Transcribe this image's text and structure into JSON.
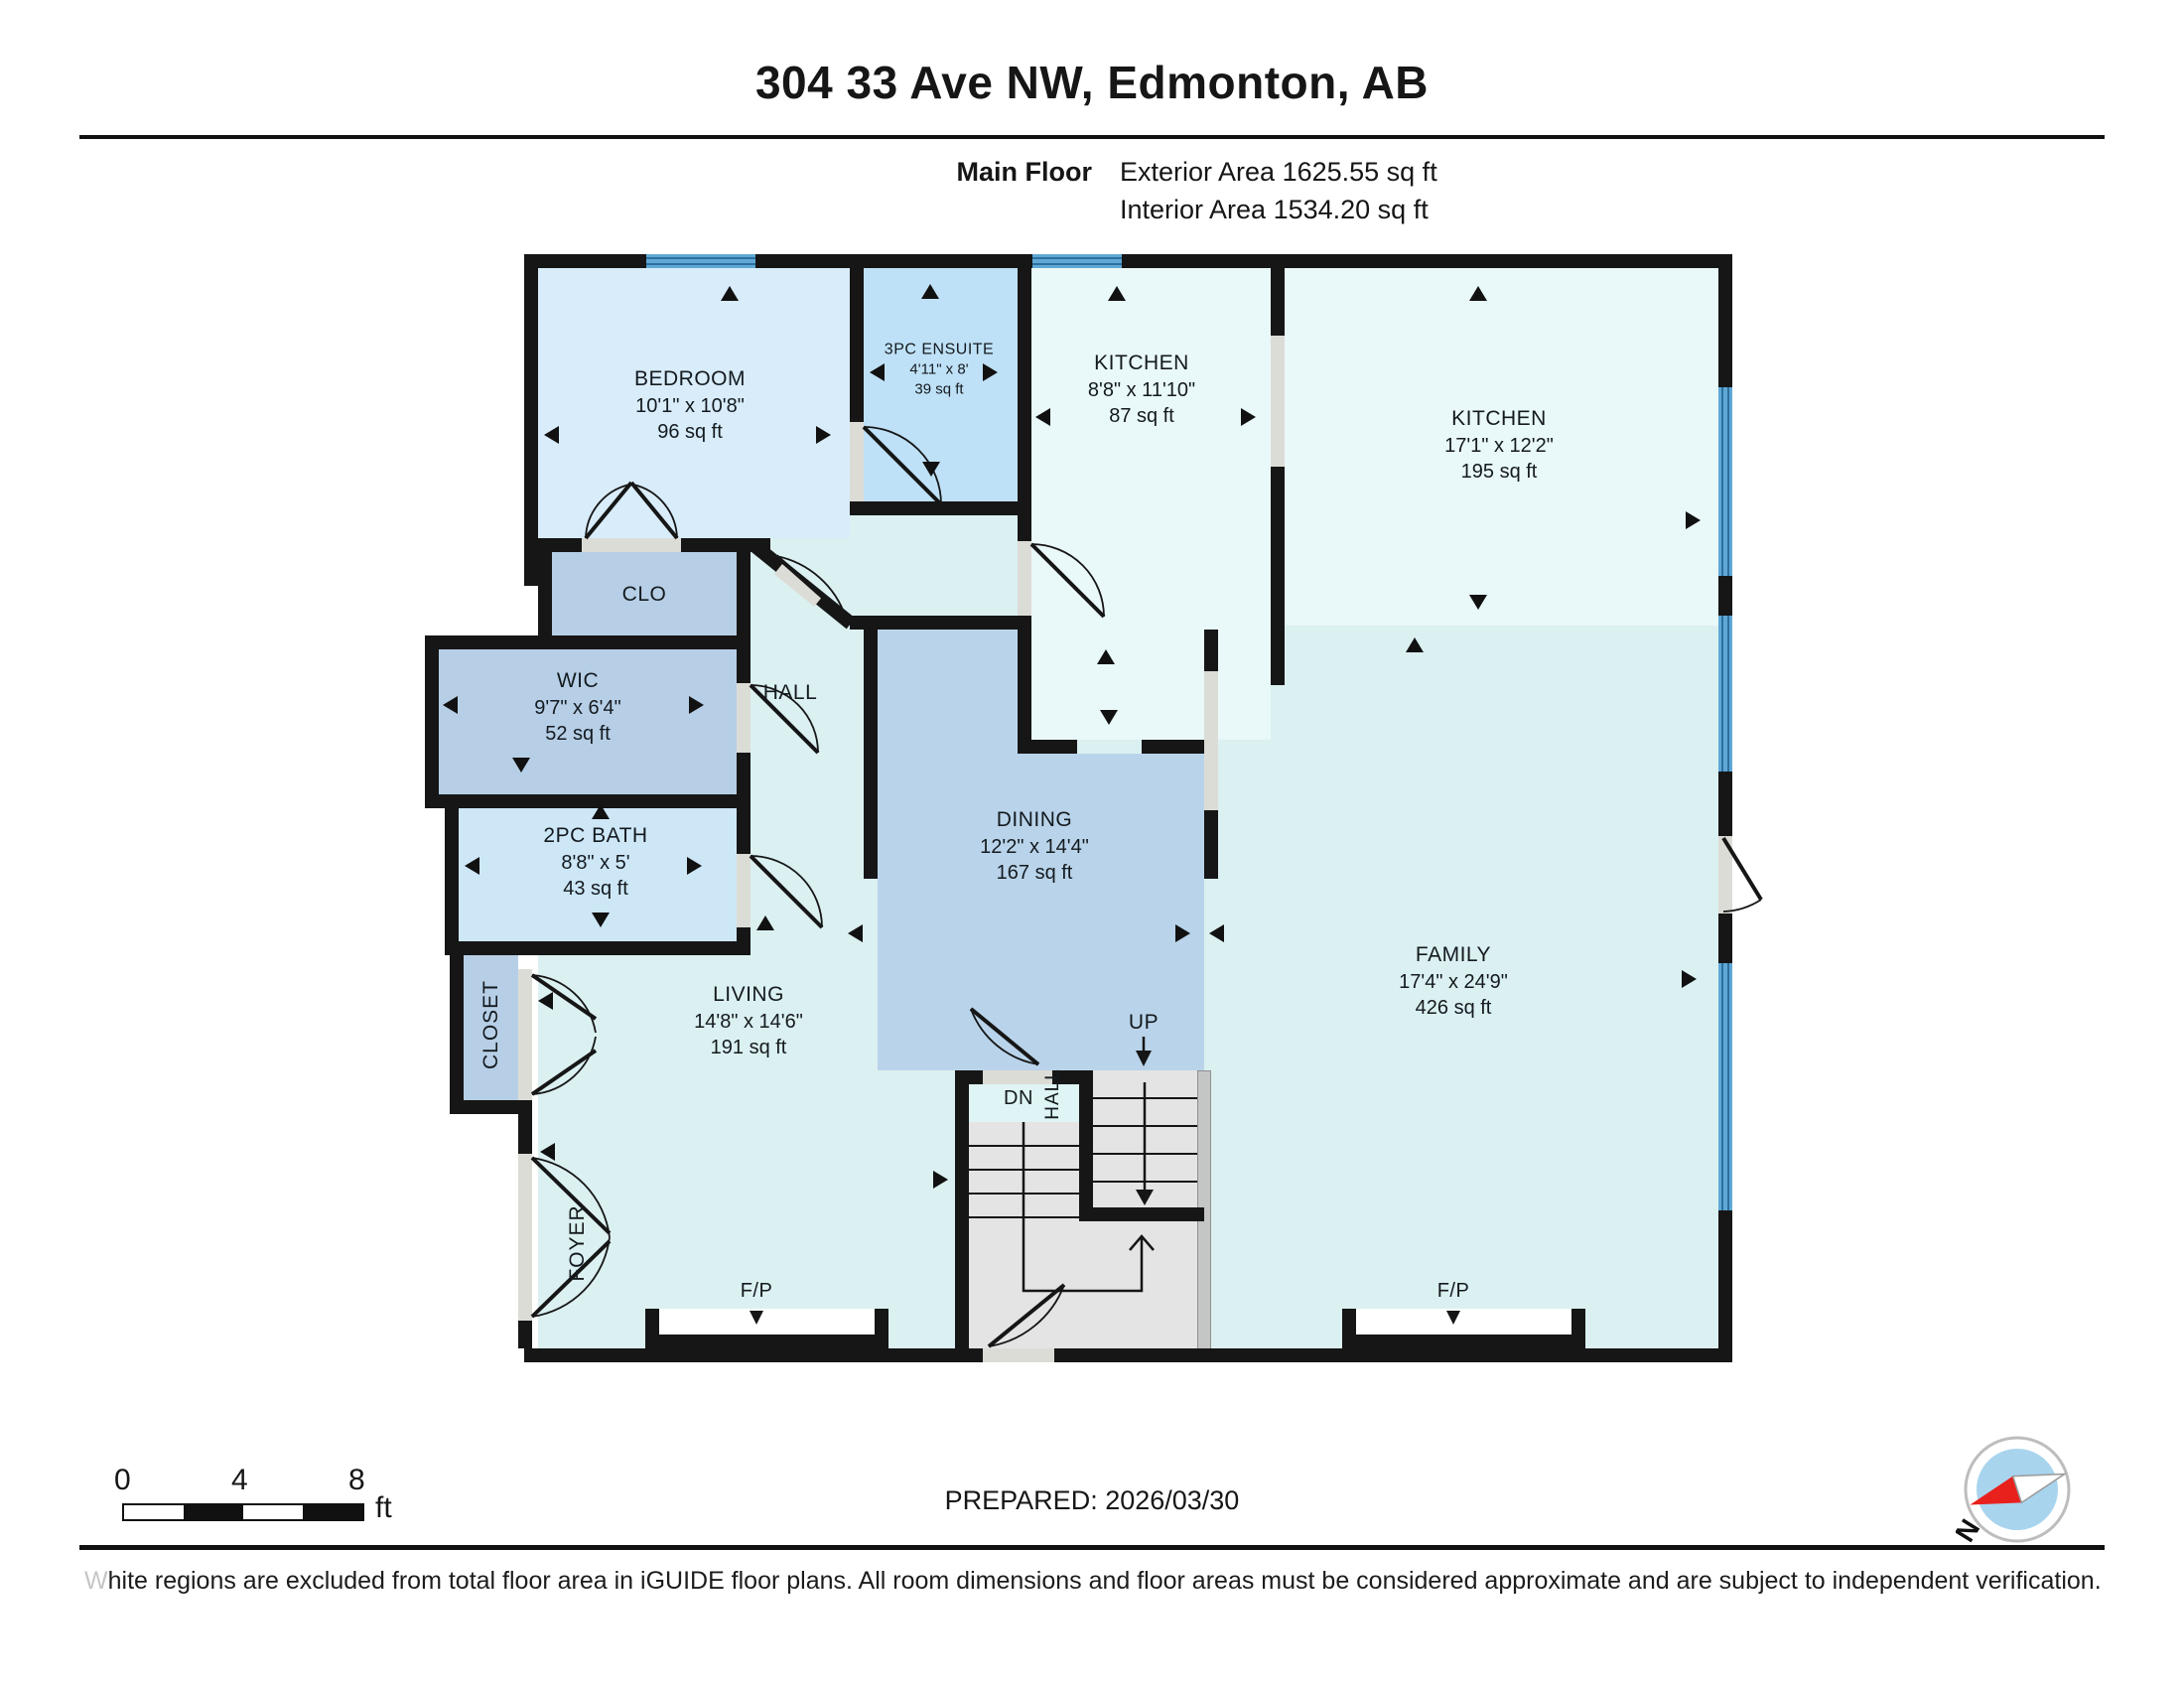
{
  "header": {
    "title": "304 33 Ave NW, Edmonton, AB",
    "floor_label": "Main Floor",
    "exterior_area": "Exterior Area 1625.55 sq ft",
    "interior_area": "Interior Area 1534.20 sq ft"
  },
  "rooms": {
    "bedroom": {
      "name": "BEDROOM",
      "dims": "10'1\" x 10'8\"",
      "area": "96 sq ft"
    },
    "ensuite": {
      "name": "3PC ENSUITE",
      "dims": "4'11\" x 8'",
      "area": "39 sq ft"
    },
    "kitchen_small": {
      "name": "KITCHEN",
      "dims": "8'8\" x 11'10\"",
      "area": "87 sq ft"
    },
    "kitchen_large": {
      "name": "KITCHEN",
      "dims": "17'1\" x 12'2\"",
      "area": "195 sq ft"
    },
    "clo": {
      "name": "CLO"
    },
    "wic": {
      "name": "WIC",
      "dims": "9'7\" x 6'4\"",
      "area": "52 sq ft"
    },
    "bath": {
      "name": "2PC BATH",
      "dims": "8'8\" x 5'",
      "area": "43 sq ft"
    },
    "hall": {
      "name": "HALL"
    },
    "dining": {
      "name": "DINING",
      "dims": "12'2\" x 14'4\"",
      "area": "167 sq ft"
    },
    "family": {
      "name": "FAMILY",
      "dims": "17'4\" x 24'9\"",
      "area": "426 sq ft"
    },
    "living": {
      "name": "LIVING",
      "dims": "14'8\" x 14'6\"",
      "area": "191 sq ft"
    },
    "closet": {
      "name": "CLOSET"
    },
    "foyer": {
      "name": "FOYER"
    },
    "stair_hall": {
      "name": "HALL"
    }
  },
  "labels": {
    "up": "UP",
    "dn": "DN",
    "fireplace": "F/P"
  },
  "scale_bar": {
    "t0": "0",
    "t4": "4",
    "t8": "8",
    "unit": "ft"
  },
  "footer": {
    "prepared": "PREPARED: 2026/03/30",
    "disclaimer_first_letter": "W",
    "disclaimer_rest": "hite regions are excluded from total floor area in iGUIDE floor plans. All room dimensions and floor areas must be considered approximate and are subject to independent verification."
  },
  "compass": {
    "north_label": "N"
  },
  "colors": {
    "wall": "#161616",
    "window_blue": "#5fa8d6",
    "window_line": "#2d6f9e",
    "base_interior": "#dbf0f1",
    "bedroom": "#d8ecfa",
    "ensuite": "#bfe1f7",
    "kitchen": "#e9f8f9",
    "dining": "#b9d4ea",
    "closet_blue": "#b6cfe6",
    "bath": "#cde7f7",
    "stairs_gray": "#e4e4e4",
    "landing_cyan": "#dff4f4",
    "compass_red": "#e8211d",
    "compass_inner": "#a8d4ee"
  }
}
